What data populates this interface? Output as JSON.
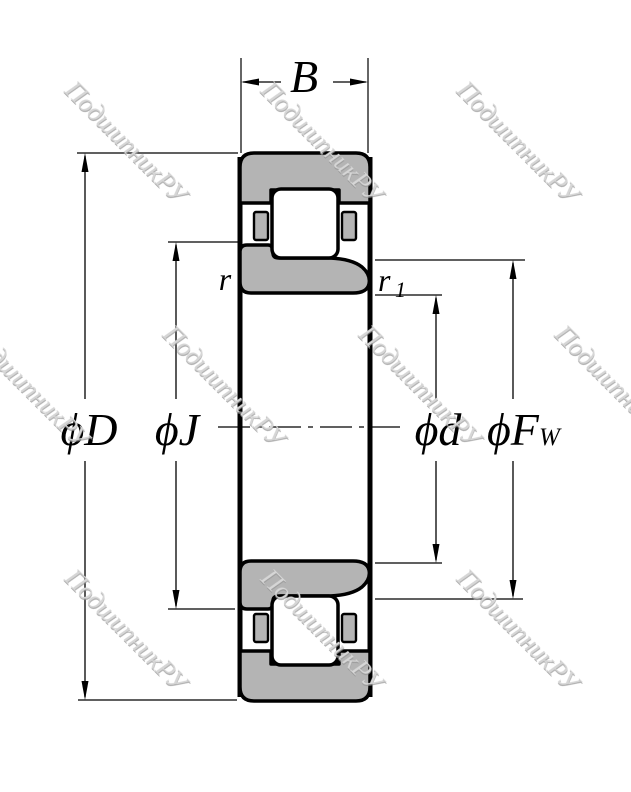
{
  "figure": {
    "type": "bearing-cross-section-drawing",
    "watermark": {
      "text": "ПодшипникРУ",
      "color": "#d6d6d6"
    },
    "labels": {
      "width": "B",
      "outer_diameter": "ϕD",
      "rib_diameter": "ϕJ",
      "bore_diameter": "ϕd",
      "raceway_diameter_main": "ϕF",
      "raceway_diameter_sub": "W",
      "chamfer_outer": "r",
      "chamfer_inner_main": "r",
      "chamfer_inner_sub": "1"
    },
    "colors": {
      "ring_fill": "#b4b4b4",
      "outline": "#000000",
      "background": "#ffffff",
      "watermark": "#d6d6d6"
    }
  }
}
